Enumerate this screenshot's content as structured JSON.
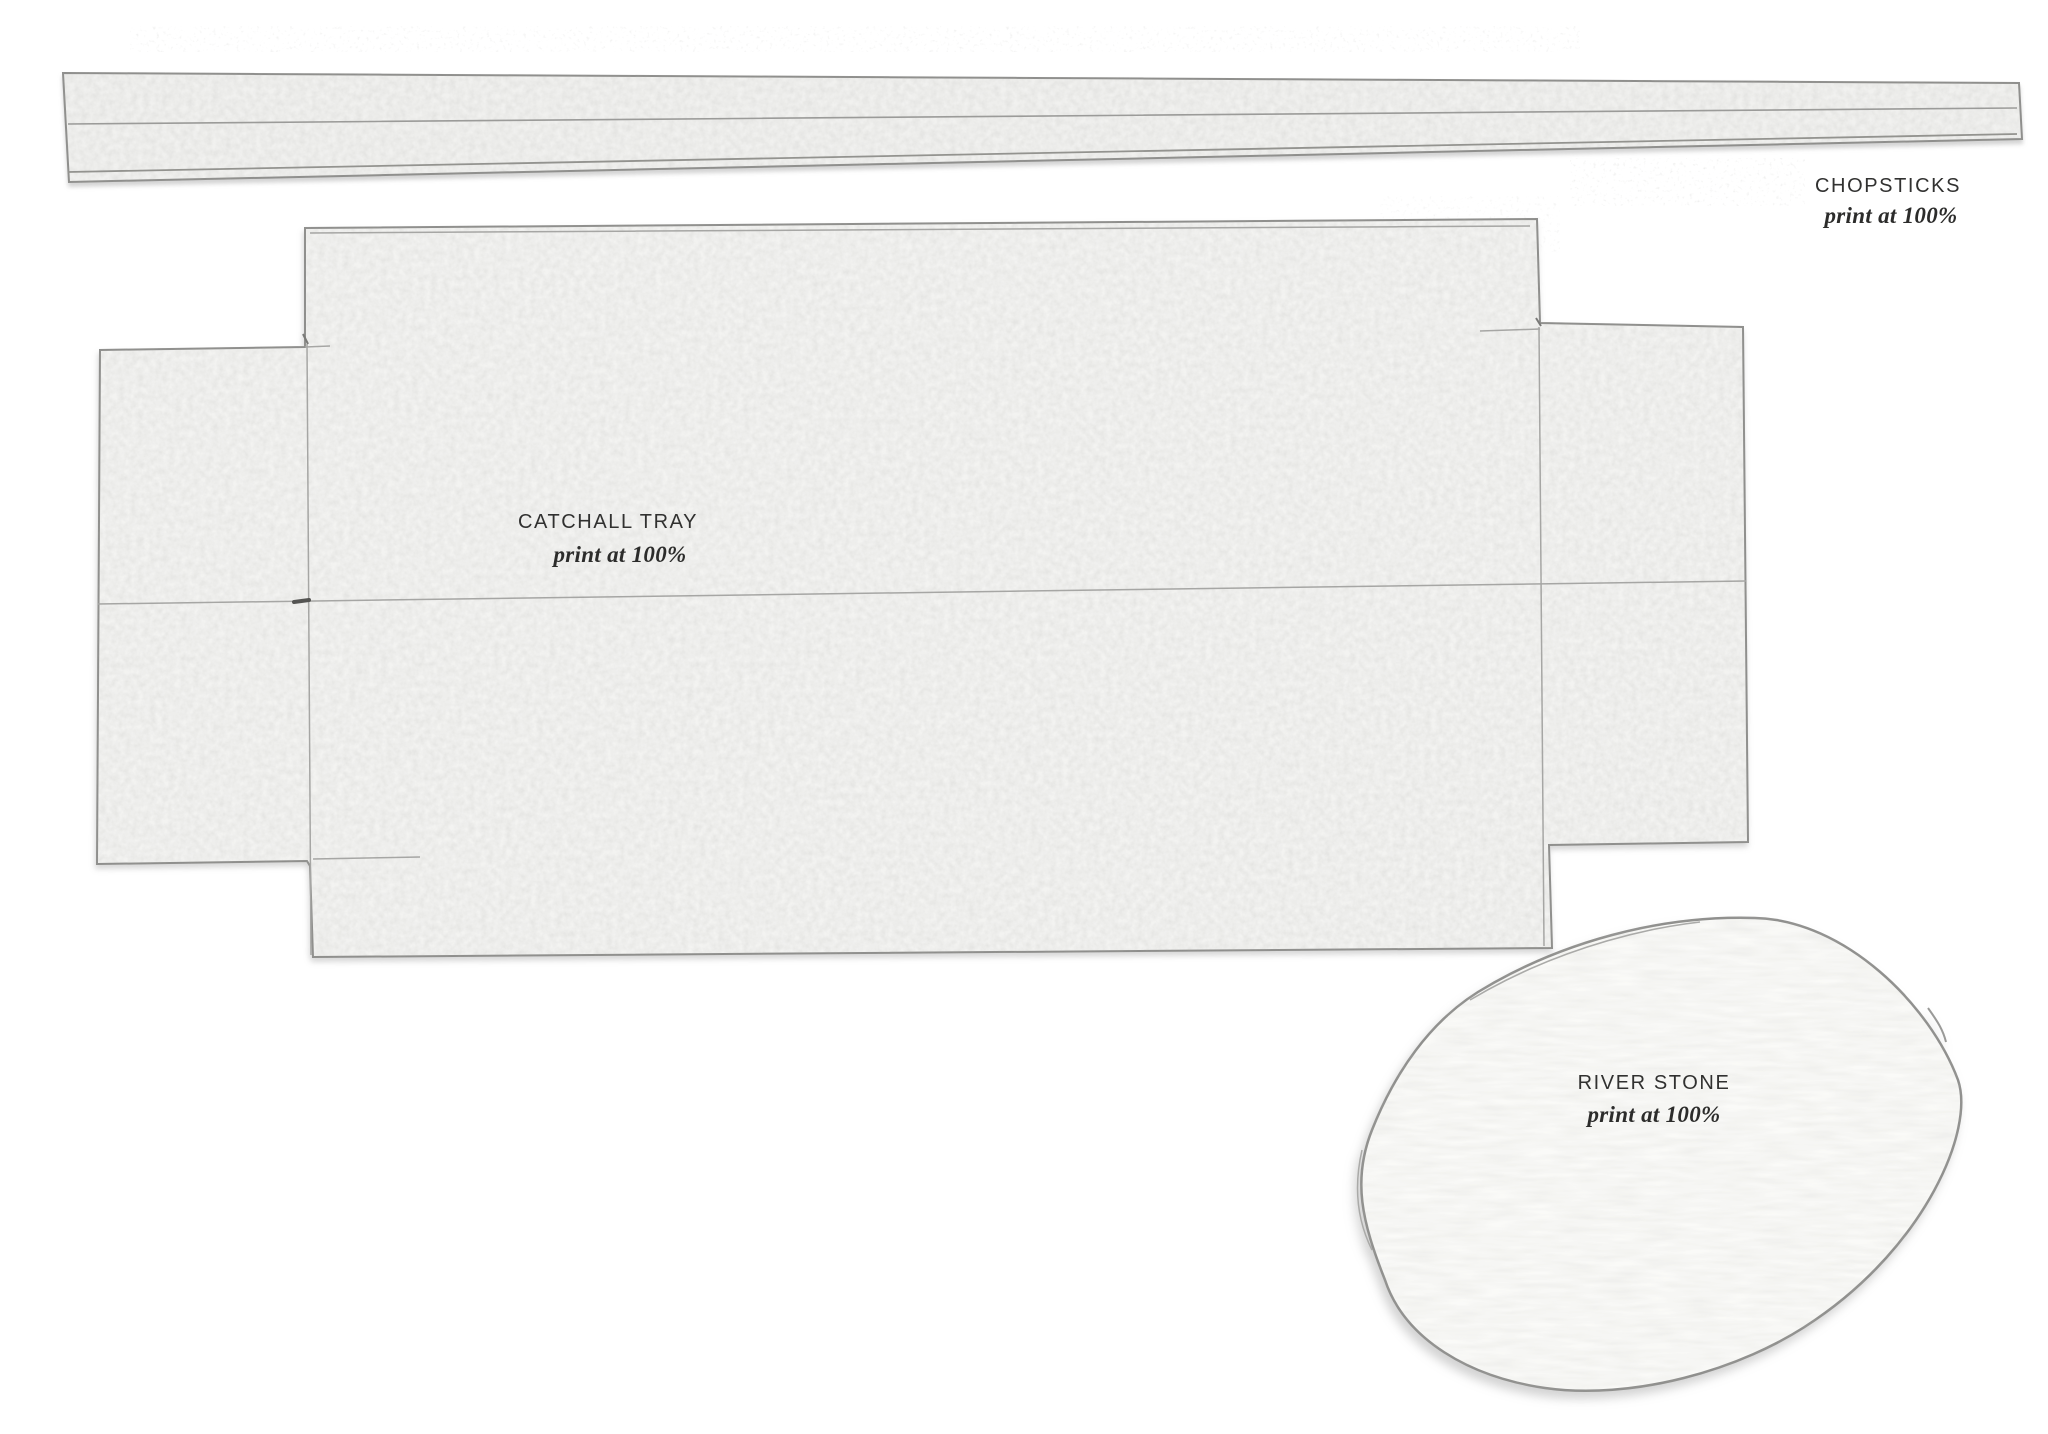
{
  "document": {
    "kind": "scanned printable craft template sheet",
    "background_color": "#ffffff"
  },
  "templates": [
    {
      "id": "chopsticks",
      "title": "CHOPSTICKS",
      "instruction": "print at 100%"
    },
    {
      "id": "catchall-tray",
      "title": "CATCHALL TRAY",
      "instruction": "print at 100%"
    },
    {
      "id": "river-stone",
      "title": "RIVER STONE",
      "instruction": "print at 100%"
    }
  ],
  "colors": {
    "paper_fill": "#f2f2f0",
    "tray_fill": "#f3f3f1",
    "stone_fill": "#fafaf8",
    "cut_edge": "#8e8e8c",
    "pencil_line": "#a6a6a4",
    "label_text": "#313130"
  }
}
